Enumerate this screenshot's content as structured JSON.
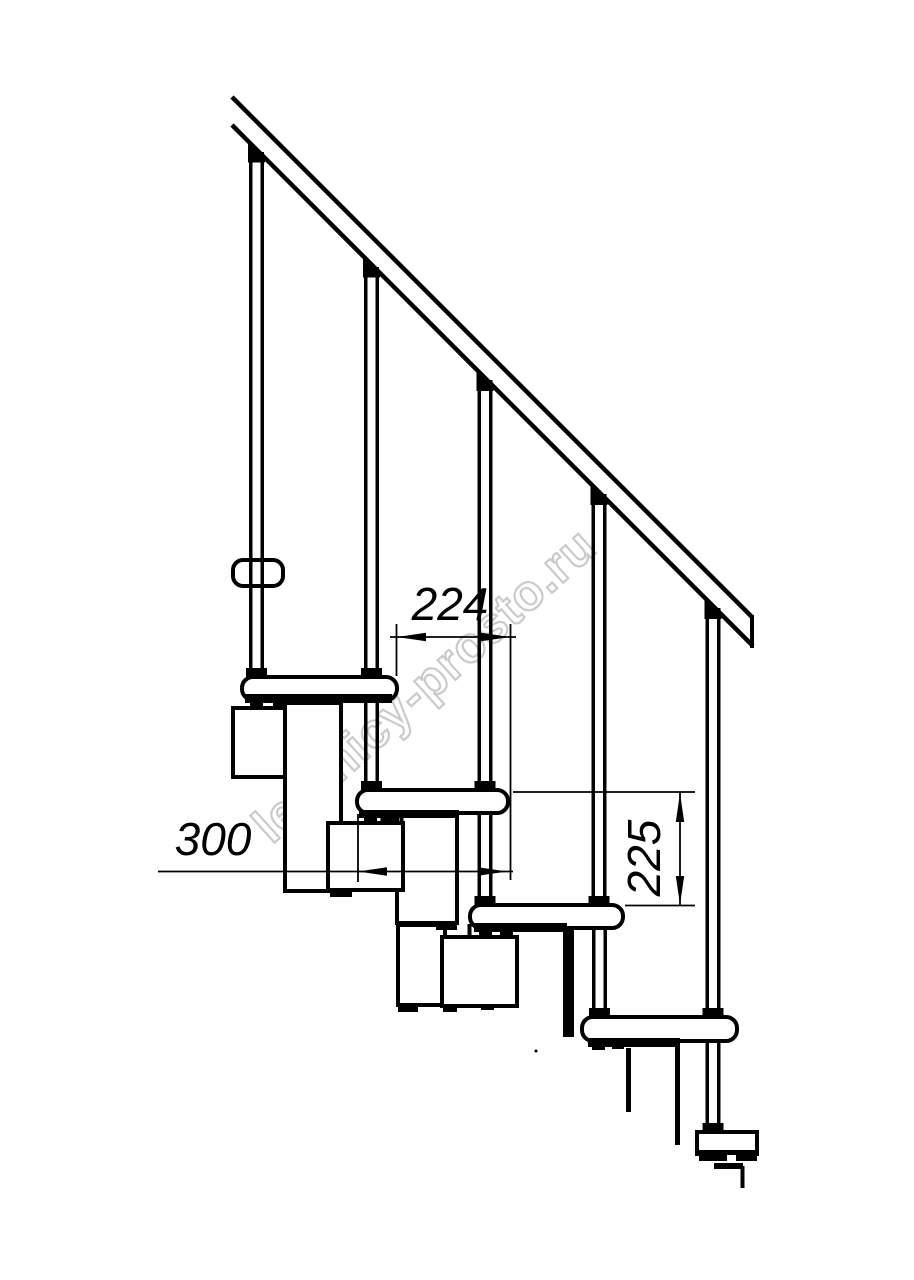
{
  "page": {
    "background": "#ffffff",
    "line_color": "#000000"
  },
  "watermark": {
    "text": "lestnicy-prosto.ru",
    "color": "#bdbdbd"
  },
  "dimensions": {
    "step_run": {
      "label": "224"
    },
    "tread_length": {
      "label": "300"
    },
    "step_rise": {
      "label": "225"
    }
  }
}
